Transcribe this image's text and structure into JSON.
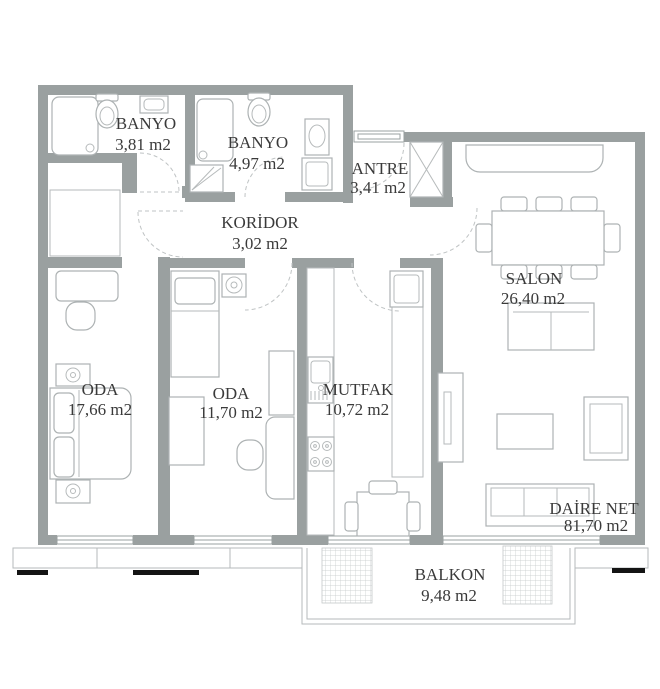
{
  "rooms": {
    "banyo_small": {
      "name": "BANYO",
      "area": "3,81 m2"
    },
    "banyo_large": {
      "name": "BANYO",
      "area": "4,97 m2"
    },
    "antre": {
      "name": "ANTRE",
      "area": "3,41 m2"
    },
    "koridor": {
      "name": "KORİDOR",
      "area": "3,02 m2"
    },
    "oda_large": {
      "name": "ODA",
      "area": "17,66 m2"
    },
    "oda_small": {
      "name": "ODA",
      "area": "11,70 m2"
    },
    "mutfak": {
      "name": "MUTFAK",
      "area": "10,72 m2"
    },
    "salon": {
      "name": "SALON",
      "area": "26,40 m2"
    },
    "balkon": {
      "name": "BALKON",
      "area": "9,48 m2"
    }
  },
  "net_area": {
    "label": "DAİRE NET",
    "value": "81,70 m2"
  },
  "colors": {
    "wall": "#9aa0a0",
    "line": "#b6babb",
    "fixture": "#adb2b3",
    "dash": "#bfc3c4",
    "text": "#3a3a3a",
    "rail": "#141414",
    "hatch": "#c4c8c9",
    "bg": "#ffffff"
  }
}
